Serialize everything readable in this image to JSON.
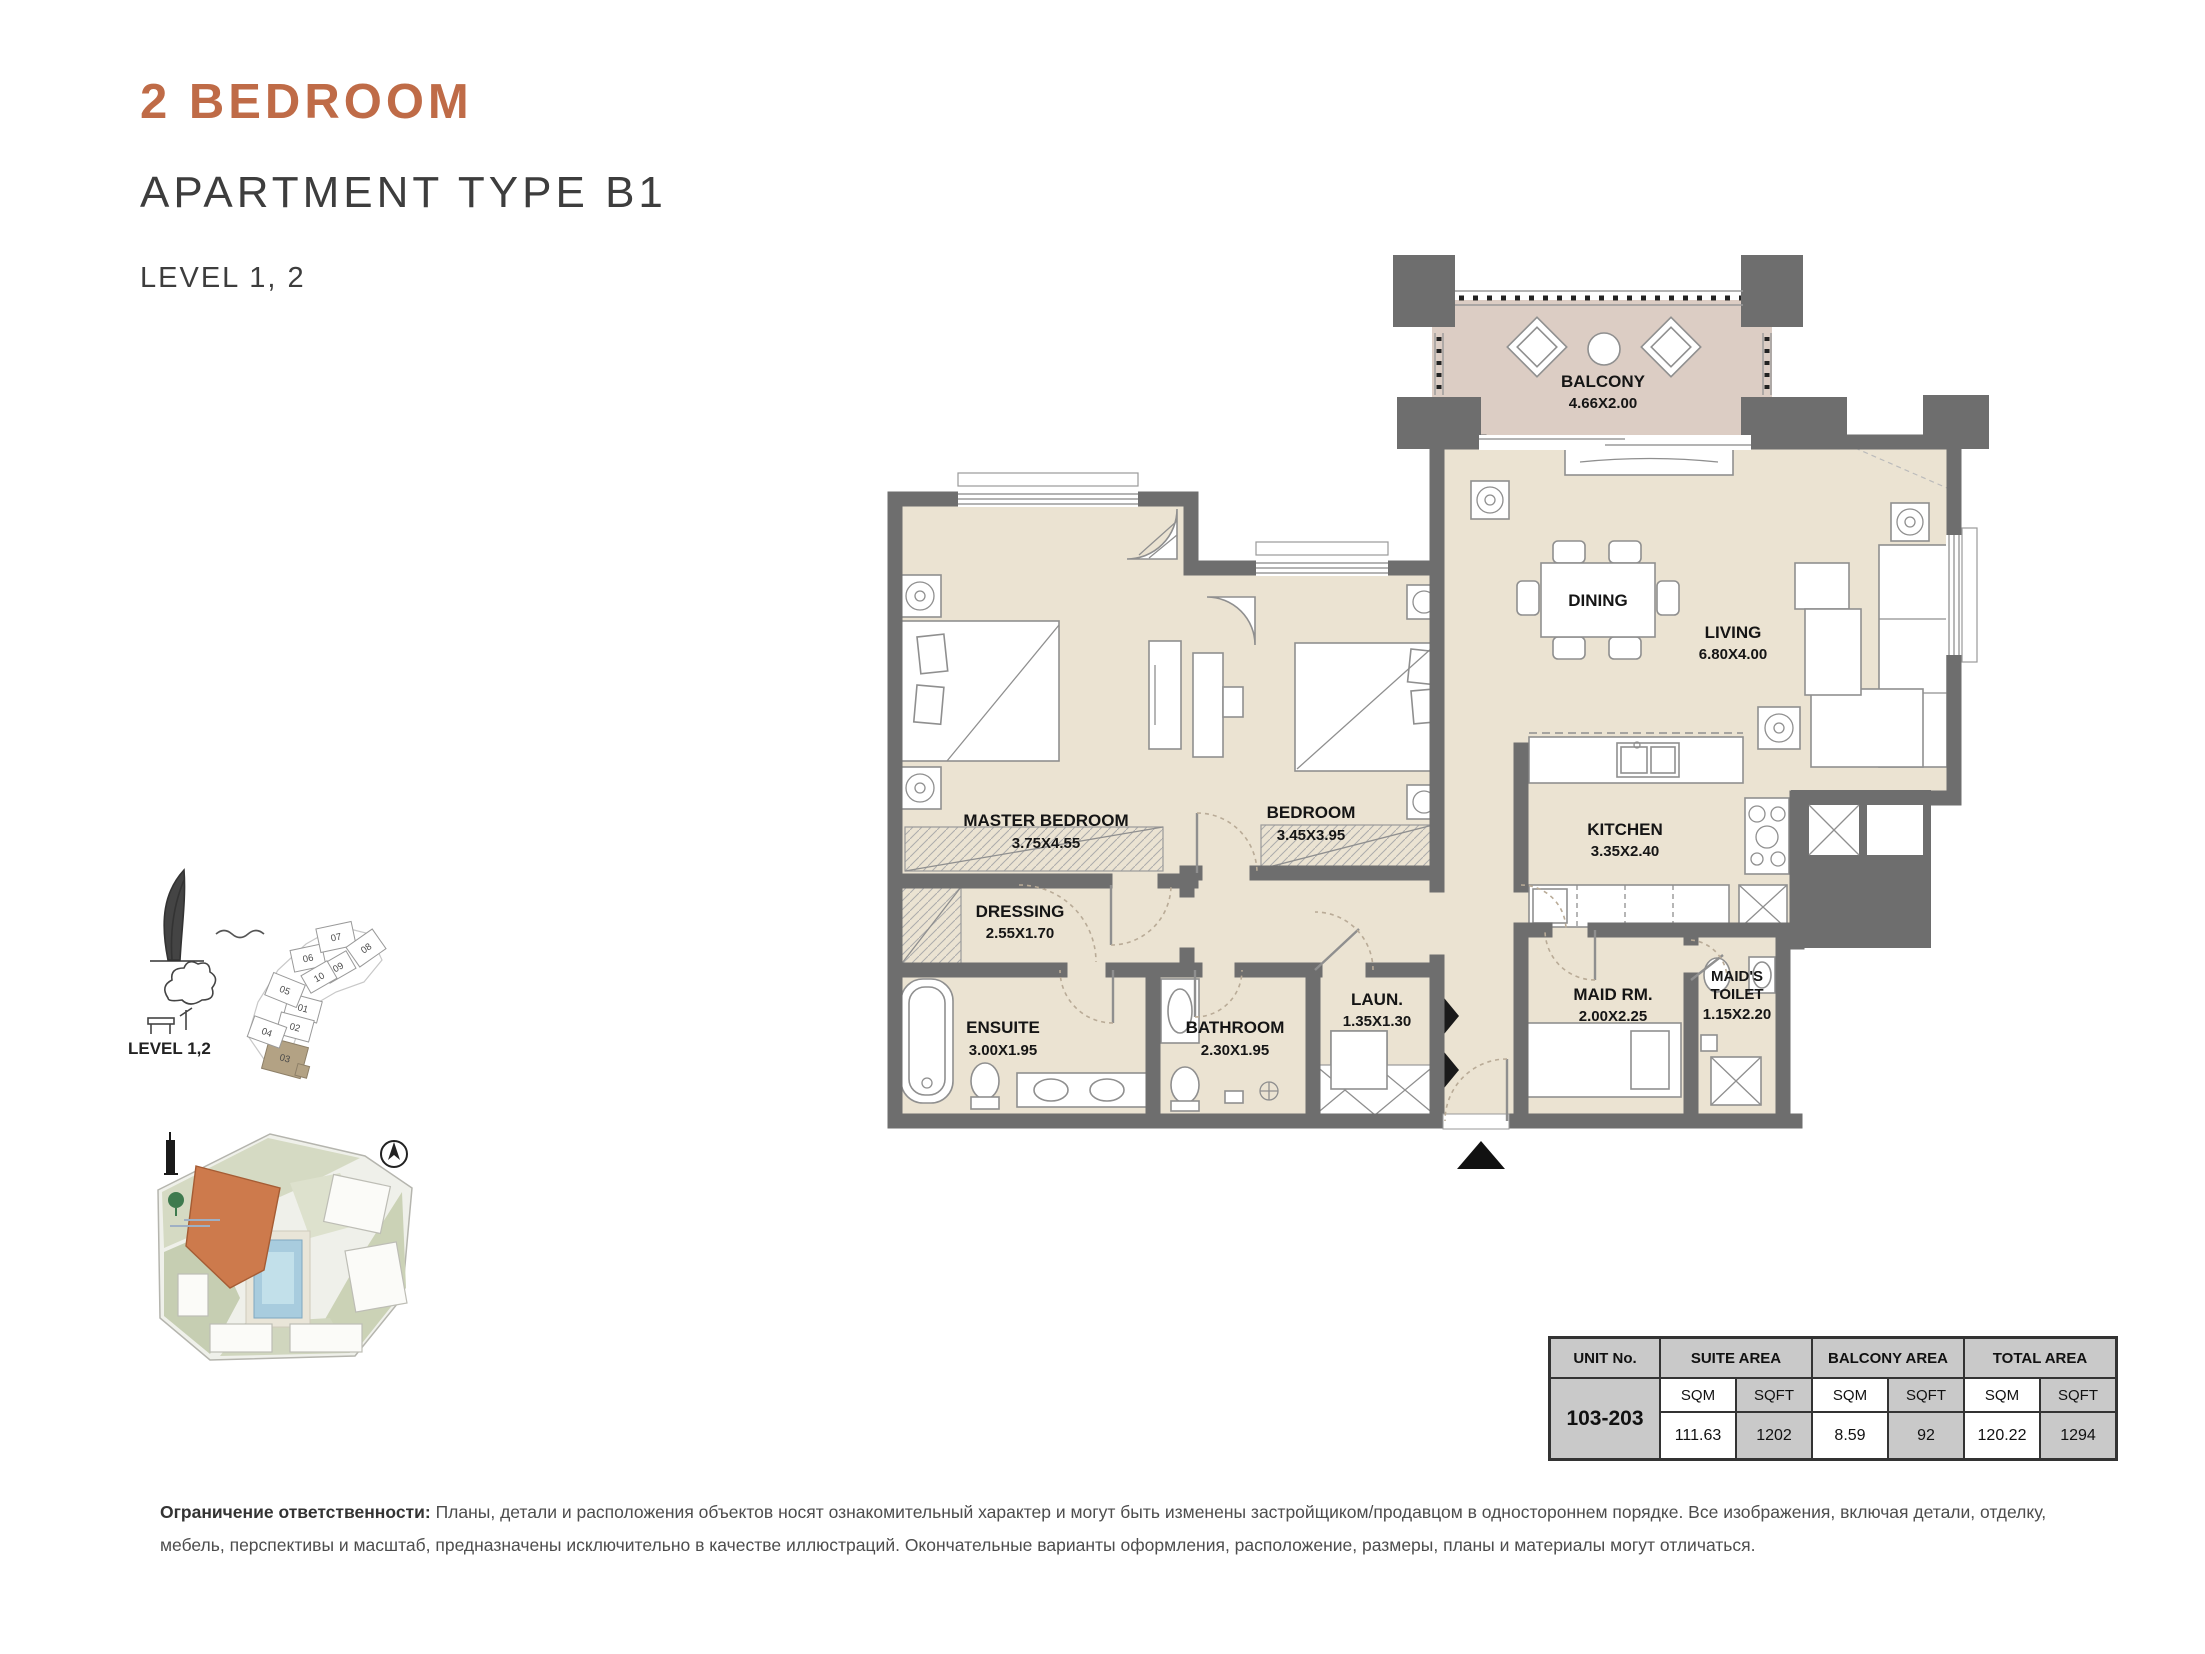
{
  "header": {
    "title": "2 BEDROOM",
    "subtitle": "APARTMENT TYPE B1",
    "level": "LEVEL 1, 2"
  },
  "colors": {
    "accent_orange": "#BF6B47",
    "wall_gray": "#6E6E6E",
    "floor_cream": "#EBE3D2",
    "balcony_floor": "#DCCDC4",
    "keyplan_highlight": "#B3A284",
    "siteplan_building": "#CD7A4C",
    "table_header_bg": "#C9C9C9"
  },
  "keyplan": {
    "level_label": "LEVEL 1,2",
    "highlighted_unit": "03",
    "units": [
      {
        "n": "01"
      },
      {
        "n": "02"
      },
      {
        "n": "03"
      },
      {
        "n": "04"
      },
      {
        "n": "05"
      },
      {
        "n": "06"
      },
      {
        "n": "07"
      },
      {
        "n": "08"
      },
      {
        "n": "09"
      },
      {
        "n": "10"
      }
    ]
  },
  "floorplan": {
    "rooms": {
      "balcony": {
        "name": "BALCONY",
        "dims": "4.66X2.00"
      },
      "dining": {
        "name": "DINING",
        "dims": ""
      },
      "living": {
        "name": "LIVING",
        "dims": "6.80X4.00"
      },
      "master": {
        "name": "MASTER BEDROOM",
        "dims": "3.75X4.55"
      },
      "bedroom": {
        "name": "BEDROOM",
        "dims": "3.45X3.95"
      },
      "kitchen": {
        "name": "KITCHEN",
        "dims": "3.35X2.40"
      },
      "dressing": {
        "name": "DRESSING",
        "dims": "2.55X1.70"
      },
      "ensuite": {
        "name": "ENSUITE",
        "dims": "3.00X1.95"
      },
      "bathroom": {
        "name": "BATHROOM",
        "dims": "2.30X1.95"
      },
      "laundry": {
        "name": "LAUN.",
        "dims": "1.35X1.30"
      },
      "maid": {
        "name": "MAID RM.",
        "dims": "2.00X2.25"
      },
      "maid_toilet": {
        "line1": "MAID'S",
        "line2": "TOILET",
        "dims": "1.15X2.20"
      }
    }
  },
  "area_table": {
    "col_unit": "UNIT No.",
    "col_suite": "SUITE AREA",
    "col_balcony": "BALCONY AREA",
    "col_total": "TOTAL AREA",
    "sqm": "SQM",
    "sqft": "SQFT",
    "unit_no": "103-203",
    "suite_sqm": "111.63",
    "suite_sqft": "1202",
    "balcony_sqm": "8.59",
    "balcony_sqft": "92",
    "total_sqm": "120.22",
    "total_sqft": "1294"
  },
  "disclaimer": {
    "label": "Ограничение ответственности:",
    "text": " Планы, детали и расположения объектов носят ознакомительный характер и могут быть изменены застройщиком/продавцом в одностороннем порядке. Все изображения, включая детали, отделку, мебель, перспективы и масштаб, предназначены исключительно в качестве иллюстраций. Окончательные варианты оформления, расположение, размеры, планы и материалы могут отличаться."
  }
}
